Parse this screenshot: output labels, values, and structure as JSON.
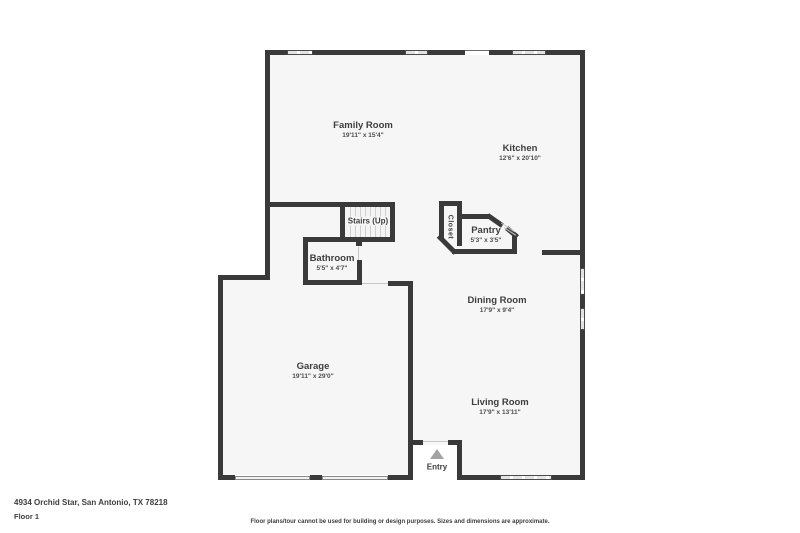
{
  "meta": {
    "address": "4934 Orchid Star, San Antonio, TX 78218",
    "floor_label": "Floor 1",
    "disclaimer": "Floor plans/tour cannot be used for building or design purposes. Sizes and dimensions are approximate."
  },
  "colors": {
    "wall": "#3a3a3a",
    "interior": "#f6f6f7",
    "window": "#e3e3e3",
    "tread_line": "#cfcfcf",
    "entry_arrow": "#a3a3a3",
    "text": "#3e3e3e"
  },
  "rooms": [
    {
      "id": "family-room",
      "name": "Family Room",
      "dims": "19'11\" x 15'4\"",
      "cx": 363,
      "cy": 130
    },
    {
      "id": "kitchen",
      "name": "Kitchen",
      "dims": "12'6\" x 20'10\"",
      "cx": 520,
      "cy": 153
    },
    {
      "id": "bathroom",
      "name": "Bathroom",
      "dims": "5'5\" x 4'7\"",
      "cx": 332,
      "cy": 263
    },
    {
      "id": "pantry",
      "name": "Pantry",
      "dims": "5'3\" x 3'5\"",
      "cx": 486,
      "cy": 235
    },
    {
      "id": "dining-room",
      "name": "Dining Room",
      "dims": "17'9\" x 9'4\"",
      "cx": 497,
      "cy": 305
    },
    {
      "id": "garage",
      "name": "Garage",
      "dims": "19'11\" x 29'0\"",
      "cx": 313,
      "cy": 371
    },
    {
      "id": "living-room",
      "name": "Living Room",
      "dims": "17'9\" x 13'11\"",
      "cx": 500,
      "cy": 407
    }
  ],
  "labels": {
    "stairs": {
      "text": "Stairs (Up)",
      "cx": 368,
      "cy": 221
    },
    "closet": {
      "text": "Closet",
      "cx": 450,
      "cy": 227
    },
    "entry": {
      "text": "Entry",
      "cx": 437,
      "cy": 467
    }
  },
  "plan": {
    "interior_rects": [
      [
        270,
        55,
        310,
        225
      ],
      [
        223,
        280,
        185,
        195
      ],
      [
        270,
        280,
        310,
        195
      ]
    ],
    "white_masks": [
      [
        413,
        445,
        44,
        30
      ]
    ],
    "walls": [
      [
        265,
        50,
        22,
        5
      ],
      [
        313,
        50,
        92,
        5
      ],
      [
        428,
        50,
        37,
        5
      ],
      [
        489,
        50,
        23,
        5
      ],
      [
        546,
        50,
        39,
        5
      ],
      [
        265,
        50,
        5,
        230
      ],
      [
        580,
        50,
        5,
        218
      ],
      [
        580,
        295,
        5,
        13
      ],
      [
        580,
        330,
        5,
        150
      ],
      [
        542,
        250,
        43,
        5
      ],
      [
        265,
        202,
        130,
        5
      ],
      [
        340,
        207,
        5,
        30
      ],
      [
        390,
        207,
        5,
        30
      ],
      [
        303,
        237,
        92,
        5
      ],
      [
        356,
        242,
        6,
        4
      ],
      [
        303,
        242,
        5,
        43
      ],
      [
        357,
        260,
        5,
        25
      ],
      [
        303,
        280,
        59,
        5
      ],
      [
        218,
        275,
        52,
        5
      ],
      [
        218,
        275,
        5,
        205
      ],
      [
        388,
        281,
        25,
        5
      ],
      [
        408,
        286,
        5,
        194
      ],
      [
        408,
        440,
        15,
        5
      ],
      [
        448,
        440,
        14,
        5
      ],
      [
        457,
        445,
        5,
        30
      ],
      [
        218,
        475,
        17,
        5
      ],
      [
        310,
        475,
        12,
        5
      ],
      [
        388,
        475,
        25,
        5
      ],
      [
        457,
        475,
        43,
        5
      ],
      [
        552,
        475,
        33,
        5
      ],
      [
        439,
        201,
        23,
        5
      ],
      [
        439,
        206,
        5,
        32
      ],
      [
        457,
        206,
        5,
        40
      ],
      [
        462,
        214,
        27,
        5
      ],
      [
        512,
        236,
        5,
        18
      ],
      [
        452,
        249,
        65,
        5
      ]
    ],
    "angled_walls": [
      [
        435,
        242,
        24,
        5,
        45
      ],
      [
        486,
        218,
        18,
        5,
        35
      ],
      [
        505,
        230,
        14,
        5,
        40
      ]
    ],
    "windows_h": [
      [
        287,
        50,
        26,
        5
      ],
      [
        405,
        50,
        23,
        5
      ],
      [
        512,
        50,
        34,
        5
      ],
      [
        500,
        475,
        52,
        5
      ]
    ],
    "windows_v": [
      [
        580,
        268,
        5,
        27
      ],
      [
        580,
        308,
        5,
        22
      ]
    ],
    "garage_doors": [
      [
        235,
        476,
        75,
        4
      ],
      [
        322,
        476,
        66,
        4
      ]
    ],
    "thin_lines": [
      [
        358,
        247,
        1,
        13,
        0
      ],
      [
        362,
        283,
        26,
        1,
        0
      ],
      [
        423,
        441,
        25,
        1,
        0
      ],
      [
        500,
        227,
        16,
        1,
        33
      ],
      [
        503,
        231,
        14,
        1,
        33
      ]
    ],
    "thin_lines_dark": [
      [
        465,
        50,
        24,
        1,
        0
      ]
    ],
    "treads": {
      "x": 345,
      "y": 207,
      "w": 45,
      "h": 30,
      "count": 8
    },
    "entry_triangle": {
      "x": 430,
      "y": 449
    }
  }
}
